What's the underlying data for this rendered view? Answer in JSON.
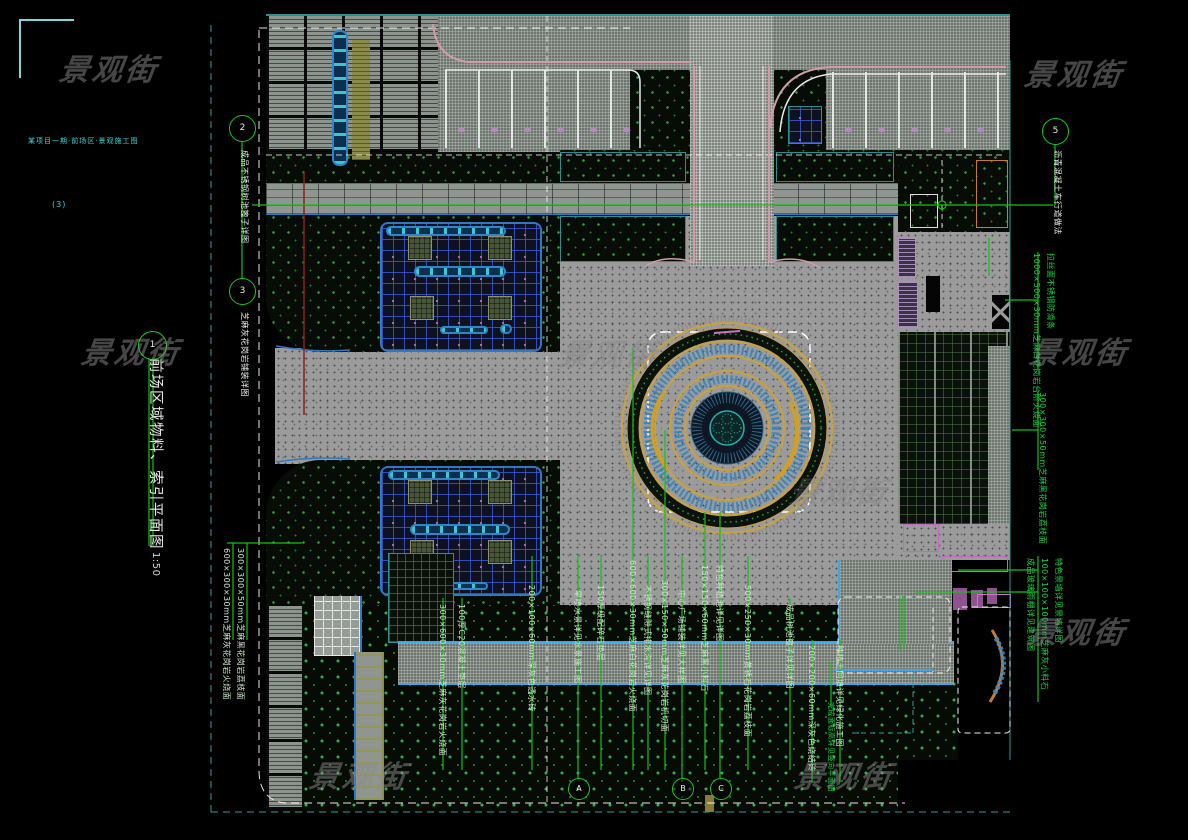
{
  "watermark": {
    "text": "景观街"
  },
  "frame": {
    "corner_note": "某项目一期·前场区·景观施工图",
    "corner_note2": "(3)"
  },
  "title": {
    "number": "1",
    "text": "前场区域物料、索引平面图",
    "scale": "1:50"
  },
  "markers": {
    "left": [
      {
        "bubble": "2",
        "label": "成品不锈钢树池篦子详图"
      },
      {
        "bubble": "3",
        "label": "芝麻灰花岗岩铺装详图"
      }
    ],
    "top_right": {
      "bubble": "5",
      "label": "沥青混凝土车行道做法"
    },
    "bottom": [
      {
        "bubble": "A"
      },
      {
        "bubble": "B"
      },
      {
        "bubble": "C"
      }
    ]
  },
  "annotations": {
    "left_pair": [
      "600×300×30mm芝麻灰花岗岩火烧面",
      "300×300×50mm芝麻黑花岗岩荔枝面"
    ],
    "right": [
      "1000×500×30mm芝麻白花岗岩台阶火烧面",
      "拉丝面不锈钢防滑条",
      "300×300×50mm芝麻黑花岗岩荔枝面",
      "成品玻璃雨棚详见建筑图",
      "100×100×100mm芝麻灰小料石",
      "特色景墙详见景墙详图"
    ],
    "bottom": [
      "300×600×30mm芝麻灰花岗岩火烧面",
      "100厚C20混凝土垫层",
      "200×100×60mm深灰色透水砖",
      "旱喷水景详见水景施工图",
      "150厚级配碎石垫层",
      "600×600×30mm芝麻白花岗岩火烧面",
      "不锈钢缝隙式排水沟详见详图",
      "300×150×50mm芝麻灰花岗岩机切面",
      "中心广场铺装详见大样图",
      "150×150×60mm芝麻黑小料石",
      "特色种植池详见详图",
      "500×250×30mm黄锈石花岗岩荔枝面",
      "成品树池篦子详见详图",
      "200×200×60mm深灰色烧结砖",
      "种植土回填详见绿化施工图"
    ],
    "misc": "完成面标高详见竖向平面图"
  },
  "colors": {
    "leader_green": "#14c114",
    "curb_pink": "#d49aa8",
    "water_blue": "#3fa7e8",
    "ring_gold": "#d4a017",
    "lattice_blue": "#3a86c0",
    "magenta": "#c06ac0",
    "boundary_teal": "#2a9f9f"
  }
}
